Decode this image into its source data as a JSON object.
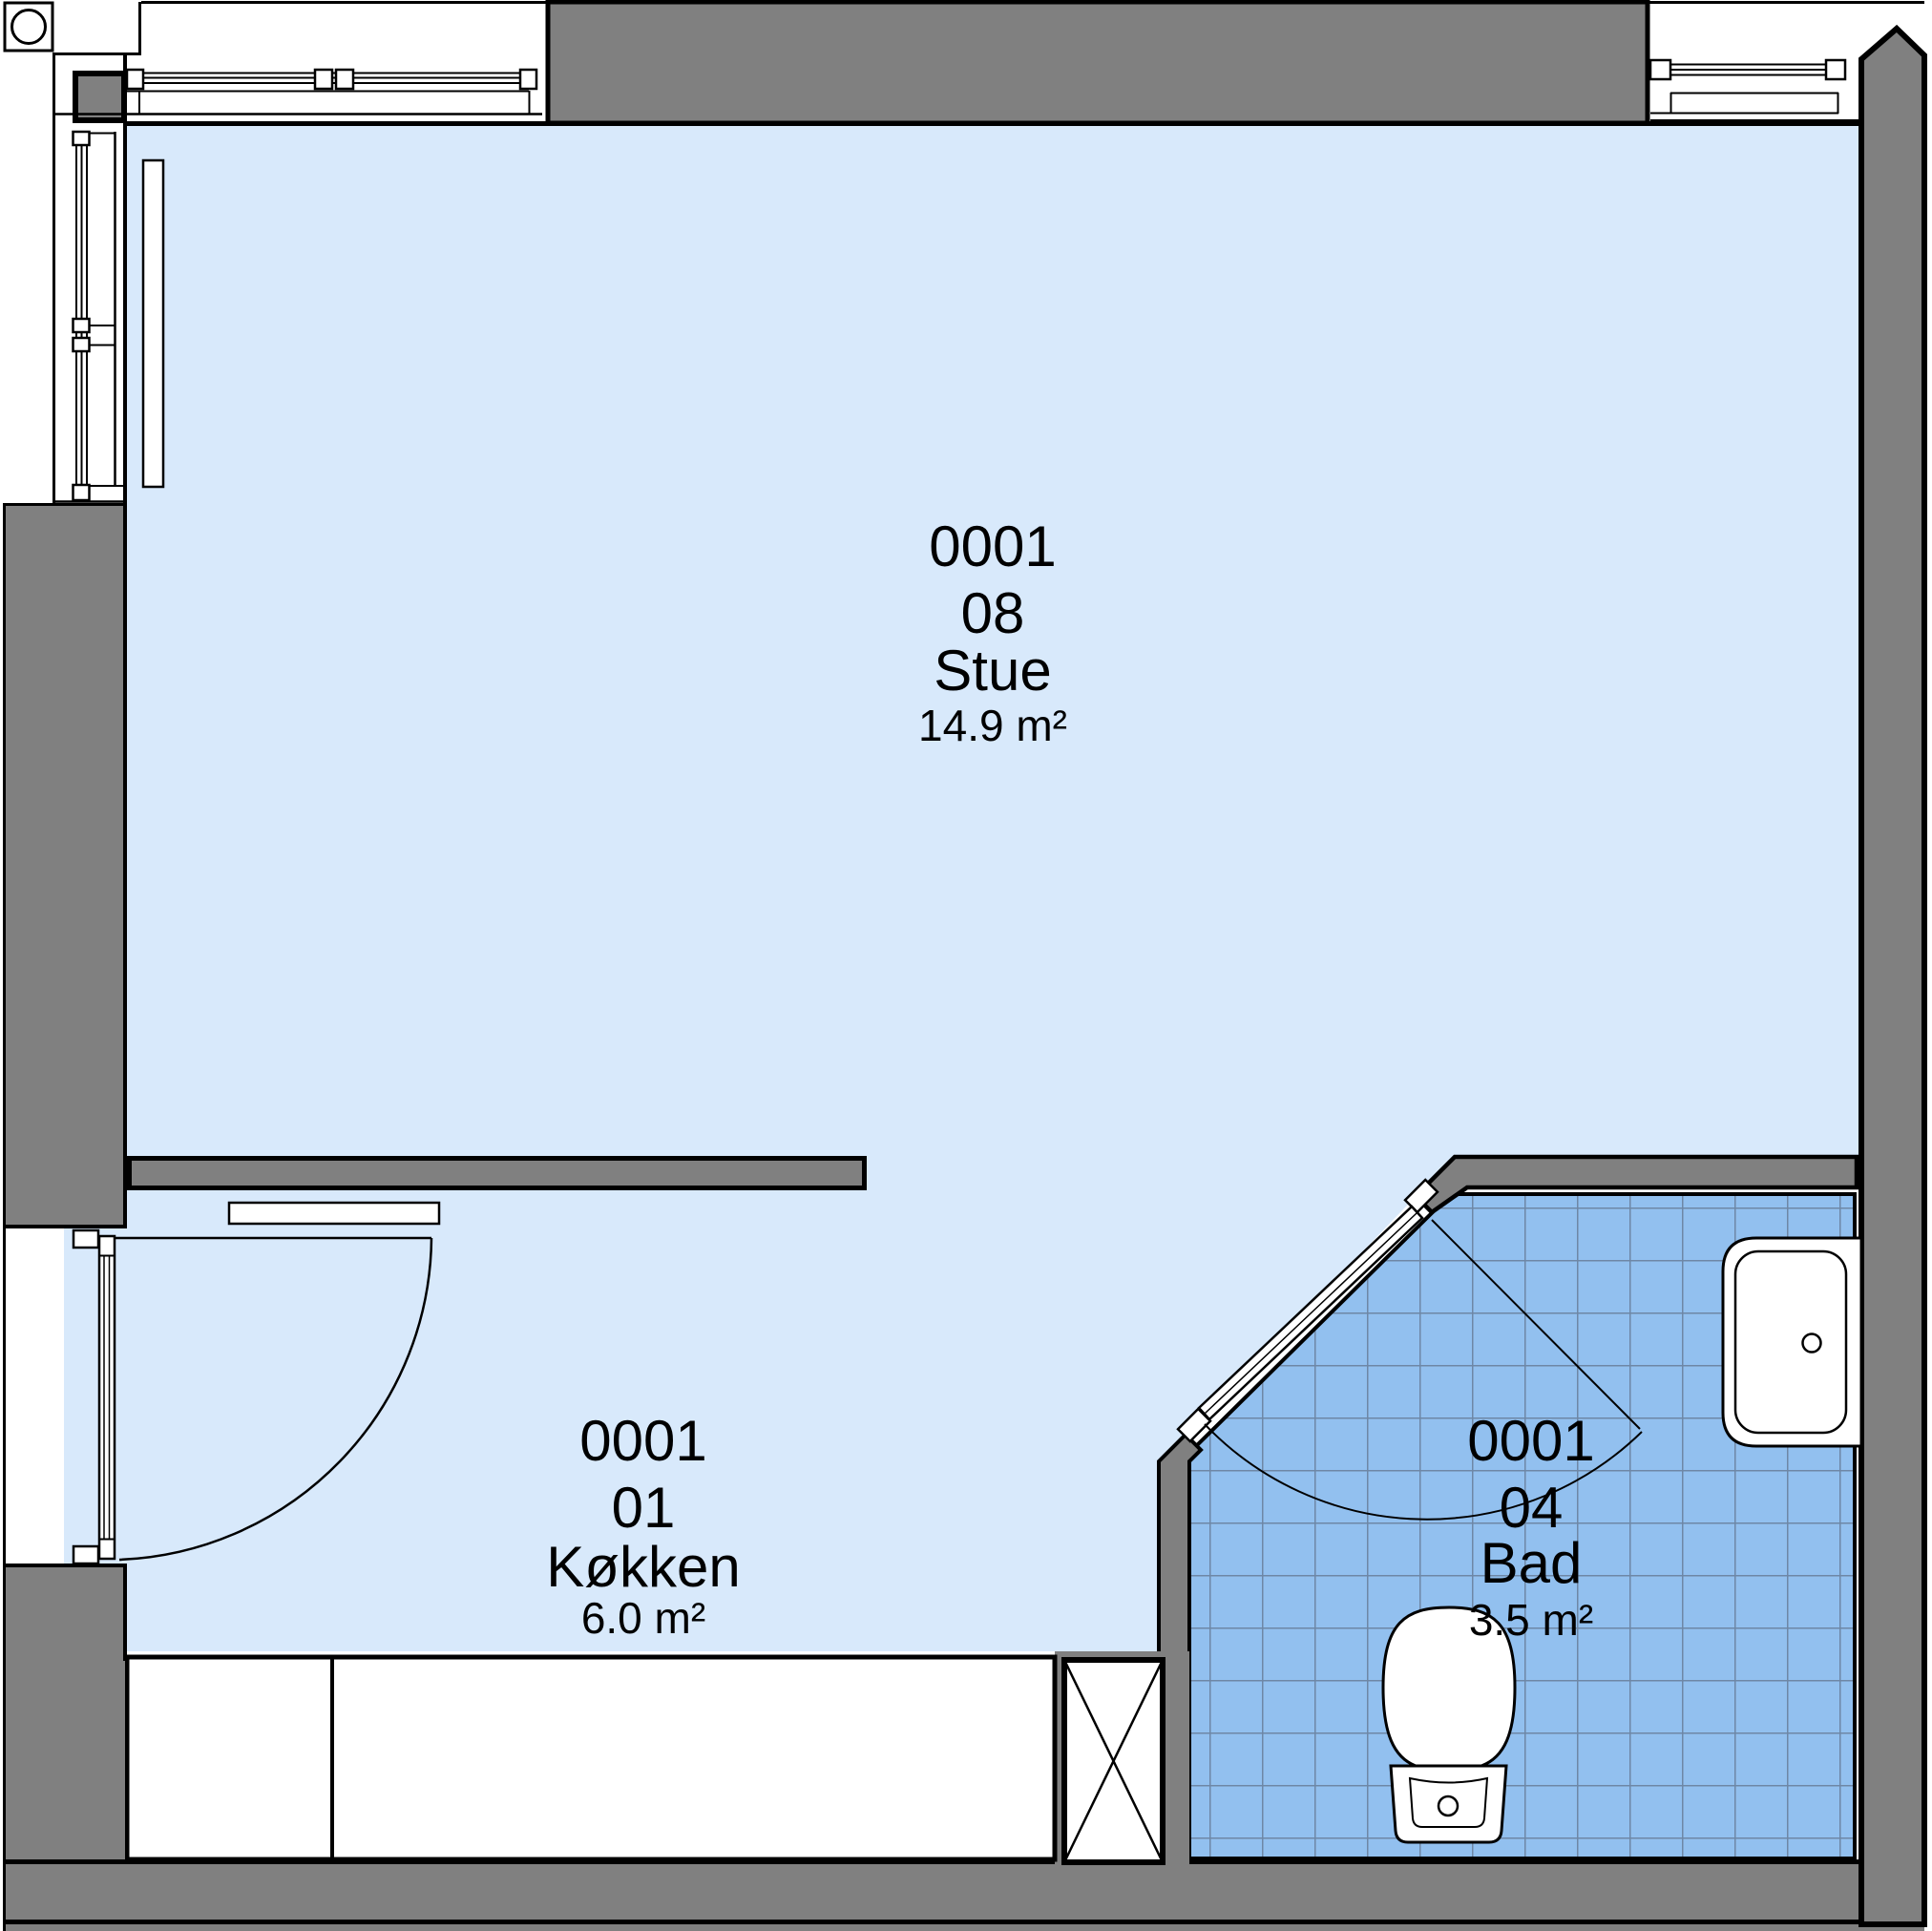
{
  "plan": {
    "rooms": [
      {
        "unit": "0001",
        "number": "08",
        "name": "Stue",
        "area": "14.9 m²"
      },
      {
        "unit": "0001",
        "number": "01",
        "name": "Køkken",
        "area": "6.0 m²"
      },
      {
        "unit": "0001",
        "number": "04",
        "name": "Bad",
        "area": "3.5 m²"
      }
    ],
    "fixtures": [
      "corner-marker",
      "column",
      "window",
      "radiator",
      "entry-door",
      "wall-shelf",
      "kitchen-counter",
      "service-shaft",
      "bathroom-door",
      "washbasin",
      "toilet"
    ]
  },
  "colors": {
    "wall": "#808080",
    "floor": "#d8e9fb",
    "tile": "#92c0ef",
    "tile_grid": "#6e87a6",
    "line": "#000000"
  }
}
